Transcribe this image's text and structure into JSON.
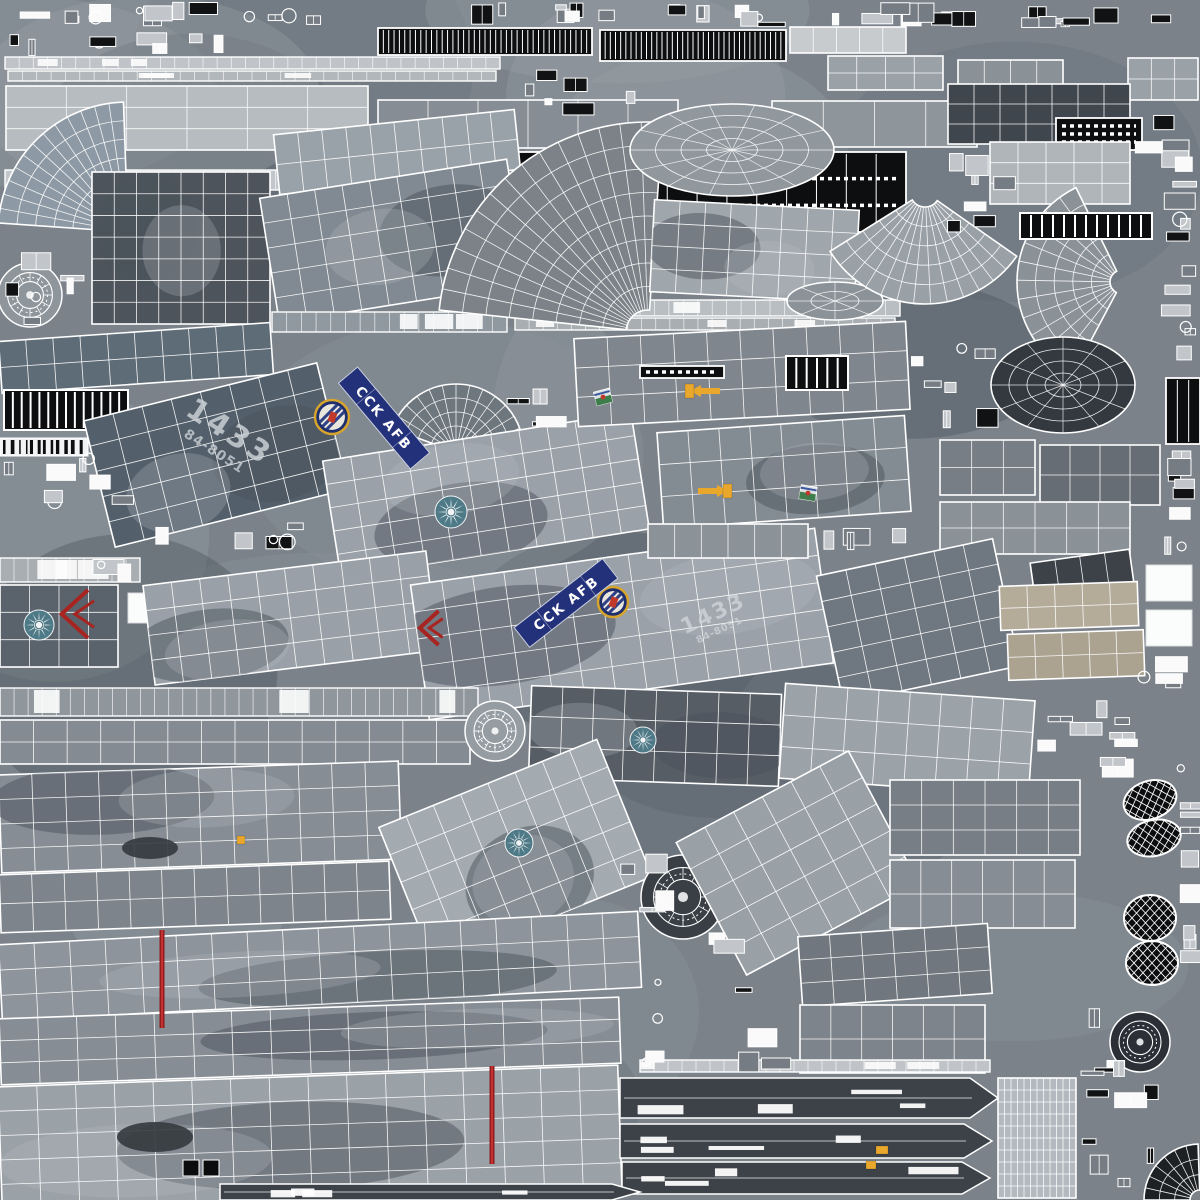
{
  "meta": {
    "kind": "uv-texture-atlas",
    "subject": "military aircraft 3D model wireframe texture",
    "canvas": 1200
  },
  "palette": {
    "base": "#7b828a",
    "wire": "#ffffff",
    "banner_blue": "#22317a",
    "roundel_blue": "#4e7a87",
    "insignia_gold": "#d7a42c",
    "marking_red": "#a82420",
    "marking_yellow": "#e9a82c",
    "tire_black": "#0b0c0d",
    "panel_dark": "#4d545b",
    "panel_light": "#a9aeb3",
    "seat_tan": "#b4ab99",
    "blob_dark": "#5a626b",
    "blob_light": "#969da3"
  },
  "decals": {
    "banners": [
      {
        "text": "CCK AFB",
        "x": 384,
        "y": 418,
        "rot": 50,
        "len": 112,
        "wd": 25
      },
      {
        "text": "CCK AFB",
        "x": 566,
        "y": 603,
        "rot": -38,
        "len": 112,
        "wd": 25
      }
    ],
    "serials": [
      {
        "big": "1433",
        "small": "84-8051",
        "x": 224,
        "y": 440,
        "rot": 33,
        "scale": 1
      },
      {
        "big": "1433",
        "small": "84-8051",
        "x": 716,
        "y": 620,
        "rot": -25,
        "scale": 0.72
      }
    ],
    "roundels": [
      {
        "x": 451,
        "y": 512,
        "r": 16
      },
      {
        "x": 39,
        "y": 625,
        "r": 15
      },
      {
        "x": 643,
        "y": 740,
        "r": 13
      },
      {
        "x": 519,
        "y": 843,
        "r": 14
      }
    ],
    "badges": [
      {
        "x": 332,
        "y": 417,
        "r": 17
      },
      {
        "x": 613,
        "y": 602,
        "r": 15
      }
    ],
    "patches": [
      {
        "x": 603,
        "y": 397,
        "rot": -15
      },
      {
        "x": 808,
        "y": 493,
        "rot": 10
      }
    ],
    "chevrons": [
      {
        "x": 76,
        "y": 614,
        "s": 24
      },
      {
        "x": 430,
        "y": 628,
        "s": 17
      }
    ],
    "arrows": [
      {
        "x": 706,
        "y": 391,
        "dir": "left"
      },
      {
        "x": 712,
        "y": 491,
        "dir": "right"
      }
    ],
    "stripes": [
      {
        "x": 162,
        "y": 930,
        "h": 98
      },
      {
        "x": 492,
        "y": 1066,
        "h": 98
      }
    ],
    "accents": [
      {
        "x": 685,
        "y": 384,
        "w": 9,
        "h": 14
      },
      {
        "x": 723,
        "y": 484,
        "w": 9,
        "h": 14
      },
      {
        "x": 866,
        "y": 1161,
        "w": 10,
        "h": 8
      },
      {
        "x": 876,
        "y": 1146,
        "w": 12,
        "h": 8
      },
      {
        "x": 237,
        "y": 836,
        "w": 8,
        "h": 8
      }
    ],
    "blotches": [
      {
        "cx": 155,
        "cy": 1137,
        "rx": 38,
        "ry": 15
      },
      {
        "cx": 150,
        "cy": 848,
        "rx": 28,
        "ry": 11
      }
    ],
    "squares": [
      {
        "x": 183,
        "y": 1160,
        "s": 16
      },
      {
        "x": 203,
        "y": 1160,
        "s": 16
      }
    ]
  },
  "islands": [
    {
      "t": "strip",
      "x": 5,
      "y": 57,
      "w": 495,
      "h": 12,
      "f": "#c0c4c8"
    },
    {
      "t": "strip",
      "x": 8,
      "y": 71,
      "w": 488,
      "h": 10,
      "f": "#b2b7bb"
    },
    {
      "t": "dash",
      "x": 378,
      "y": 28,
      "w": 214,
      "h": 27,
      "seg": 40,
      "rows": 0
    },
    {
      "t": "dash",
      "x": 600,
      "y": 30,
      "w": 186,
      "h": 31,
      "seg": 36,
      "rows": 0
    },
    {
      "t": "grid",
      "x": 790,
      "y": 27,
      "w": 116,
      "h": 26,
      "r": 0,
      "c": 5,
      "rw": 1,
      "f": "#c7cbce"
    },
    {
      "t": "grid",
      "x": 6,
      "y": 86,
      "w": 362,
      "h": 64,
      "r": 0,
      "c": 6,
      "rw": 3,
      "f": "#b7bcc0"
    },
    {
      "t": "grid",
      "x": 378,
      "y": 100,
      "w": 300,
      "h": 48,
      "r": 0,
      "c": 6,
      "rw": 1,
      "f": "#868d94"
    },
    {
      "t": "grid",
      "x": 772,
      "y": 101,
      "w": 205,
      "h": 46,
      "r": 0,
      "c": 4,
      "rw": 1,
      "f": "#8e959b"
    },
    {
      "t": "strip",
      "x": 5,
      "y": 170,
      "w": 498,
      "h": 20,
      "f": "#c3c7cb"
    },
    {
      "t": "strip",
      "x": 5,
      "y": 198,
      "w": 492,
      "h": 18,
      "f": "#b8bdc1"
    },
    {
      "t": "dash",
      "x": 518,
      "y": 152,
      "w": 388,
      "h": 80,
      "seg": 13,
      "rows": 2
    },
    {
      "t": "grid",
      "x": 828,
      "y": 56,
      "w": 115,
      "h": 34,
      "r": 0,
      "c": 4,
      "rw": 2,
      "f": "#9aa1a7"
    },
    {
      "t": "grid",
      "x": 958,
      "y": 60,
      "w": 105,
      "h": 30,
      "r": 0,
      "c": 4,
      "rw": 1,
      "f": "#8a9197"
    },
    {
      "t": "grid",
      "x": 1128,
      "y": 58,
      "w": 70,
      "h": 42,
      "r": 0,
      "c": 3,
      "rw": 2,
      "f": "#9aa1a7"
    },
    {
      "t": "grid",
      "x": 948,
      "y": 84,
      "w": 182,
      "h": 60,
      "r": 0,
      "c": 7,
      "rw": 3,
      "f": "#40464d"
    },
    {
      "t": "dash",
      "x": 1056,
      "y": 118,
      "w": 86,
      "h": 32,
      "seg": 0,
      "rows": 3
    },
    {
      "t": "grid",
      "x": 990,
      "y": 142,
      "w": 140,
      "h": 62,
      "r": 0,
      "c": 5,
      "rw": 3,
      "f": "#b0b5ba"
    },
    {
      "t": "fan",
      "cx": 128,
      "cy": 232,
      "r0": 18,
      "r1": 130,
      "a0": 184,
      "a1": 268,
      "sp": 13,
      "ri": 6,
      "f": "#8d99a4"
    },
    {
      "t": "grid",
      "x": 92,
      "y": 172,
      "w": 178,
      "h": 152,
      "r": 0,
      "c": 8,
      "rw": 7,
      "f": "#4d545b",
      "cam": 1
    },
    {
      "t": "grid",
      "x": 276,
      "y": 122,
      "w": 242,
      "h": 60,
      "r": -6,
      "c": 10,
      "rw": 2,
      "f": "#9aa2a9"
    },
    {
      "t": "grid",
      "x": 268,
      "y": 178,
      "w": 250,
      "h": 126,
      "r": -9,
      "c": 9,
      "rw": 5,
      "f": "#818a92",
      "cam": 1
    },
    {
      "t": "strip",
      "x": 272,
      "y": 312,
      "w": 235,
      "h": 20,
      "f": "#9099a0"
    },
    {
      "t": "strip",
      "x": 510,
      "y": 300,
      "w": 390,
      "h": 16,
      "f": "#b9bec3"
    },
    {
      "t": "strip",
      "x": 515,
      "y": 318,
      "w": 380,
      "h": 12,
      "f": "#a9aeb3"
    },
    {
      "t": "fan",
      "cx": 456,
      "cy": 452,
      "r0": 12,
      "r1": 68,
      "a0": 200,
      "a1": 340,
      "sp": 12,
      "ri": 4,
      "f": "#6e767e"
    },
    {
      "t": "fan",
      "cx": 648,
      "cy": 332,
      "r0": 22,
      "r1": 210,
      "a0": 186,
      "a1": 274,
      "sp": 15,
      "ri": 8,
      "f": "#7c8287"
    },
    {
      "t": "dome",
      "cx": 732,
      "cy": 150,
      "rx": 102,
      "ry": 46,
      "sp": 14,
      "ri": 4,
      "f": "#90979d"
    },
    {
      "t": "grid",
      "x": 652,
      "y": 205,
      "w": 205,
      "h": 92,
      "r": 3,
      "c": 8,
      "rw": 4,
      "f": "#a0a7ac",
      "cam": 1
    },
    {
      "t": "dome",
      "cx": 835,
      "cy": 301,
      "rx": 48,
      "ry": 19,
      "sp": 8,
      "ri": 2,
      "f": "#8b9298"
    },
    {
      "t": "fan",
      "cx": 925,
      "cy": 192,
      "r0": 15,
      "r1": 112,
      "a0": 35,
      "a1": 148,
      "sp": 13,
      "ri": 5,
      "f": "#99a0a6"
    },
    {
      "t": "fan",
      "cx": 1122,
      "cy": 282,
      "r0": 12,
      "r1": 105,
      "a0": 118,
      "a1": 244,
      "sp": 12,
      "ri": 5,
      "f": "#8a9197"
    },
    {
      "t": "dash",
      "x": 1166,
      "y": 378,
      "w": 34,
      "h": 66,
      "seg": 3,
      "rows": 0
    },
    {
      "t": "grid",
      "x": 0,
      "y": 332,
      "w": 272,
      "h": 52,
      "r": -4,
      "c": 10,
      "rw": 2,
      "f": "#5e6c78"
    },
    {
      "t": "bar",
      "x": 4,
      "y": 390,
      "w": 124,
      "h": 40,
      "seg": 14
    },
    {
      "t": "barcode",
      "x": 0,
      "y": 438,
      "w": 88,
      "h": 18
    },
    {
      "t": "grid",
      "x": 96,
      "y": 390,
      "w": 240,
      "h": 130,
      "r": -14,
      "c": 8,
      "rw": 5,
      "f": "#53606b",
      "cam": 1
    },
    {
      "t": "grid",
      "x": 330,
      "y": 436,
      "w": 312,
      "h": 118,
      "r": -9,
      "c": 11,
      "rw": 5,
      "f": "#9aa1a8",
      "cam": 1
    },
    {
      "t": "grid",
      "x": 576,
      "y": 330,
      "w": 332,
      "h": 88,
      "r": -3,
      "c": 10,
      "rw": 3,
      "f": "#7f868d"
    },
    {
      "t": "dash",
      "x": 640,
      "y": 366,
      "w": 84,
      "h": 12,
      "seg": 0,
      "rows": 1
    },
    {
      "t": "grid",
      "x": 660,
      "y": 424,
      "w": 248,
      "h": 96,
      "r": -4,
      "c": 8,
      "rw": 3,
      "f": "#848c93",
      "cam": 1
    },
    {
      "t": "bar",
      "x": 786,
      "y": 356,
      "w": 62,
      "h": 34,
      "seg": 6
    },
    {
      "t": "bar",
      "x": 1020,
      "y": 213,
      "w": 132,
      "h": 26,
      "seg": 12
    },
    {
      "t": "dome",
      "cx": 1063,
      "cy": 385,
      "rx": 72,
      "ry": 48,
      "sp": 12,
      "ri": 4,
      "f": "#34393f"
    },
    {
      "t": "grid",
      "x": 940,
      "y": 440,
      "w": 95,
      "h": 55,
      "r": 0,
      "c": 3,
      "rw": 2,
      "f": "#777e85"
    },
    {
      "t": "grid",
      "x": 1040,
      "y": 445,
      "w": 120,
      "h": 60,
      "r": 0,
      "c": 4,
      "rw": 2,
      "f": "#666d74"
    },
    {
      "t": "grid",
      "x": 940,
      "y": 502,
      "w": 190,
      "h": 52,
      "r": 0,
      "c": 6,
      "rw": 2,
      "f": "#8a9197"
    },
    {
      "t": "strip",
      "x": 0,
      "y": 558,
      "w": 140,
      "h": 24,
      "f": "#a9aeb3"
    },
    {
      "t": "grid",
      "x": 0,
      "y": 585,
      "w": 118,
      "h": 82,
      "r": 0,
      "c": 4,
      "rw": 3,
      "f": "#5a636c"
    },
    {
      "t": "white",
      "x": 128,
      "y": 593,
      "w": 26,
      "h": 30
    },
    {
      "t": "grid",
      "x": 148,
      "y": 568,
      "w": 285,
      "h": 100,
      "r": -7,
      "c": 10,
      "rw": 4,
      "f": "#99a0a7",
      "cam": 1
    },
    {
      "t": "grid",
      "x": 418,
      "y": 556,
      "w": 408,
      "h": 136,
      "r": -8,
      "c": 13,
      "rw": 5,
      "f": "#9aa1a8",
      "cam": 1
    },
    {
      "t": "grid",
      "x": 828,
      "y": 556,
      "w": 180,
      "h": 130,
      "r": -12,
      "c": 6,
      "rw": 5,
      "f": "#6f7780"
    },
    {
      "t": "grid",
      "x": 1032,
      "y": 556,
      "w": 100,
      "h": 34,
      "r": -8,
      "c": 4,
      "rw": 1,
      "f": "#3c4248"
    },
    {
      "t": "grid",
      "x": 1000,
      "y": 584,
      "w": 138,
      "h": 44,
      "r": -2,
      "c": 5,
      "rw": 2,
      "f": "#b4ab99"
    },
    {
      "t": "grid",
      "x": 1008,
      "y": 632,
      "w": 136,
      "h": 46,
      "r": -2,
      "c": 5,
      "rw": 2,
      "f": "#aba290"
    },
    {
      "t": "white",
      "x": 1146,
      "y": 565,
      "w": 46,
      "h": 36
    },
    {
      "t": "white",
      "x": 1146,
      "y": 610,
      "w": 46,
      "h": 36
    },
    {
      "t": "strip",
      "x": 0,
      "y": 688,
      "w": 478,
      "h": 28,
      "f": "#8f969c"
    },
    {
      "t": "grid",
      "x": 0,
      "y": 720,
      "w": 470,
      "h": 44,
      "r": 0,
      "c": 14,
      "rw": 2,
      "f": "#848b92"
    },
    {
      "t": "hub",
      "cx": 495,
      "cy": 731,
      "r": 30,
      "f": "#959ca2",
      "sp": 1
    },
    {
      "t": "grid",
      "x": 530,
      "y": 690,
      "w": 250,
      "h": 92,
      "r": 2,
      "c": 8,
      "rw": 3,
      "f": "#565d64",
      "cam": 1
    },
    {
      "t": "grid",
      "x": 782,
      "y": 692,
      "w": 250,
      "h": 95,
      "r": 4,
      "c": 8,
      "rw": 3,
      "f": "#9ba2a8"
    },
    {
      "t": "grid",
      "x": 0,
      "y": 768,
      "w": 400,
      "h": 98,
      "r": -2,
      "c": 12,
      "rw": 4,
      "f": "#868d94",
      "cam": 1
    },
    {
      "t": "grid",
      "x": 0,
      "y": 868,
      "w": 390,
      "h": 58,
      "r": -2,
      "c": 12,
      "rw": 2,
      "f": "#7d848b"
    },
    {
      "t": "grid",
      "x": 398,
      "y": 778,
      "w": 235,
      "h": 148,
      "r": -22,
      "c": 8,
      "rw": 5,
      "f": "#a3aab0",
      "cam": 1
    },
    {
      "t": "hub",
      "cx": 683,
      "cy": 897,
      "r": 42,
      "f": "#3a3f45",
      "sp": 1
    },
    {
      "t": "grid",
      "x": 700,
      "y": 788,
      "w": 195,
      "h": 150,
      "r": -28,
      "c": 6,
      "rw": 5,
      "f": "#99a0a6"
    },
    {
      "t": "grid",
      "x": 890,
      "y": 780,
      "w": 190,
      "h": 75,
      "r": 0,
      "c": 6,
      "rw": 3,
      "f": "#777e85"
    },
    {
      "t": "grid",
      "x": 890,
      "y": 860,
      "w": 185,
      "h": 68,
      "r": 0,
      "c": 6,
      "rw": 2,
      "f": "#868d94"
    },
    {
      "t": "tire",
      "cx": 1150,
      "cy": 800,
      "rx": 27,
      "ry": 19,
      "r": -18
    },
    {
      "t": "tire",
      "cx": 1154,
      "cy": 838,
      "rx": 27,
      "ry": 18,
      "r": -12
    },
    {
      "t": "tire",
      "cx": 1150,
      "cy": 918,
      "rx": 26,
      "ry": 23,
      "r": 0
    },
    {
      "t": "tire",
      "cx": 1152,
      "cy": 963,
      "rx": 26,
      "ry": 22,
      "r": 0
    },
    {
      "t": "grid",
      "x": 0,
      "y": 928,
      "w": 640,
      "h": 76,
      "r": -3,
      "c": 18,
      "rw": 3,
      "f": "#8d949b",
      "cam": 1
    },
    {
      "t": "grid",
      "x": 0,
      "y": 1008,
      "w": 620,
      "h": 66,
      "r": -2,
      "c": 16,
      "rw": 3,
      "f": "#868d94",
      "cam": 1
    },
    {
      "t": "grid",
      "x": 800,
      "y": 930,
      "w": 190,
      "h": 70,
      "r": -4,
      "c": 6,
      "rw": 3,
      "f": "#70777e"
    },
    {
      "t": "grid",
      "x": 800,
      "y": 1005,
      "w": 185,
      "h": 68,
      "r": 0,
      "c": 6,
      "rw": 2,
      "f": "#7d848b"
    },
    {
      "t": "hub",
      "cx": 1140,
      "cy": 1042,
      "r": 30,
      "f": "#2c3036",
      "sp": 0
    },
    {
      "t": "grid",
      "x": 0,
      "y": 1076,
      "w": 620,
      "h": 122,
      "r": -2,
      "c": 16,
      "rw": 5,
      "f": "#9aa1a7",
      "cam": 1
    },
    {
      "t": "slab",
      "x": 620,
      "y": 1078,
      "w": 378,
      "h": 40
    },
    {
      "t": "slab",
      "x": 620,
      "y": 1124,
      "w": 372,
      "h": 34
    },
    {
      "t": "slab",
      "x": 622,
      "y": 1162,
      "w": 368,
      "h": 32
    },
    {
      "t": "slab",
      "x": 220,
      "y": 1184,
      "w": 420,
      "h": 16
    },
    {
      "t": "grid",
      "x": 998,
      "y": 1078,
      "w": 78,
      "h": 120,
      "r": 0,
      "c": 12,
      "rw": 10,
      "f": "#b4b9bf"
    },
    {
      "t": "fan",
      "cx": 1200,
      "cy": 1200,
      "r0": 10,
      "r1": 56,
      "a0": 180,
      "a1": 268,
      "sp": 7,
      "ri": 3,
      "f": "#1e2124"
    },
    {
      "t": "hub",
      "cx": 30,
      "cy": 295,
      "r": 32,
      "f": "#8e959b",
      "sp": 1
    },
    {
      "t": "grid",
      "x": 648,
      "y": 524,
      "w": 160,
      "h": 34,
      "r": 0,
      "c": 6,
      "rw": 1,
      "f": "#8b9298"
    },
    {
      "t": "strip",
      "x": 640,
      "y": 1060,
      "w": 350,
      "h": 12,
      "f": "#c0c4c8"
    }
  ],
  "clutter": [
    {
      "x": 0,
      "y": 2,
      "w": 368,
      "h": 24,
      "n": 14
    },
    {
      "x": 425,
      "y": 2,
      "w": 205,
      "h": 24,
      "n": 8
    },
    {
      "x": 645,
      "y": 2,
      "w": 175,
      "h": 26,
      "n": 8
    },
    {
      "x": 830,
      "y": 2,
      "w": 175,
      "h": 26,
      "n": 8
    },
    {
      "x": 1012,
      "y": 2,
      "w": 186,
      "h": 28,
      "n": 8
    },
    {
      "x": 0,
      "y": 30,
      "w": 125,
      "h": 26,
      "n": 4
    },
    {
      "x": 132,
      "y": 30,
      "w": 118,
      "h": 26,
      "n": 4
    },
    {
      "x": 520,
      "y": 58,
      "w": 115,
      "h": 58,
      "n": 6
    },
    {
      "x": 915,
      "y": 148,
      "w": 112,
      "h": 84,
      "n": 8
    },
    {
      "x": 1132,
      "y": 104,
      "w": 66,
      "h": 100,
      "n": 6
    },
    {
      "x": 1160,
      "y": 180,
      "w": 40,
      "h": 190,
      "n": 10
    },
    {
      "x": 1164,
      "y": 450,
      "w": 34,
      "h": 108,
      "n": 8
    },
    {
      "x": 0,
      "y": 240,
      "w": 88,
      "h": 88,
      "n": 6
    },
    {
      "x": 0,
      "y": 442,
      "w": 142,
      "h": 76,
      "n": 8
    },
    {
      "x": 505,
      "y": 380,
      "w": 68,
      "h": 56,
      "n": 4
    },
    {
      "x": 905,
      "y": 332,
      "w": 95,
      "h": 98,
      "n": 7
    },
    {
      "x": 812,
      "y": 524,
      "w": 126,
      "h": 34,
      "n": 4
    },
    {
      "x": 1134,
      "y": 648,
      "w": 64,
      "h": 44,
      "n": 4
    },
    {
      "x": 1035,
      "y": 692,
      "w": 165,
      "h": 86,
      "n": 10
    },
    {
      "x": 640,
      "y": 932,
      "w": 158,
      "h": 140,
      "n": 10
    },
    {
      "x": 1078,
      "y": 1000,
      "w": 50,
      "h": 78,
      "n": 5
    },
    {
      "x": 1082,
      "y": 1082,
      "w": 80,
      "h": 110,
      "n": 7
    },
    {
      "x": 610,
      "y": 845,
      "w": 66,
      "h": 86,
      "n": 4
    },
    {
      "x": 1180,
      "y": 782,
      "w": 20,
      "h": 214,
      "n": 8
    },
    {
      "x": 85,
      "y": 555,
      "w": 52,
      "h": 28,
      "n": 3
    },
    {
      "x": 150,
      "y": 522,
      "w": 195,
      "h": 38,
      "n": 6
    }
  ]
}
